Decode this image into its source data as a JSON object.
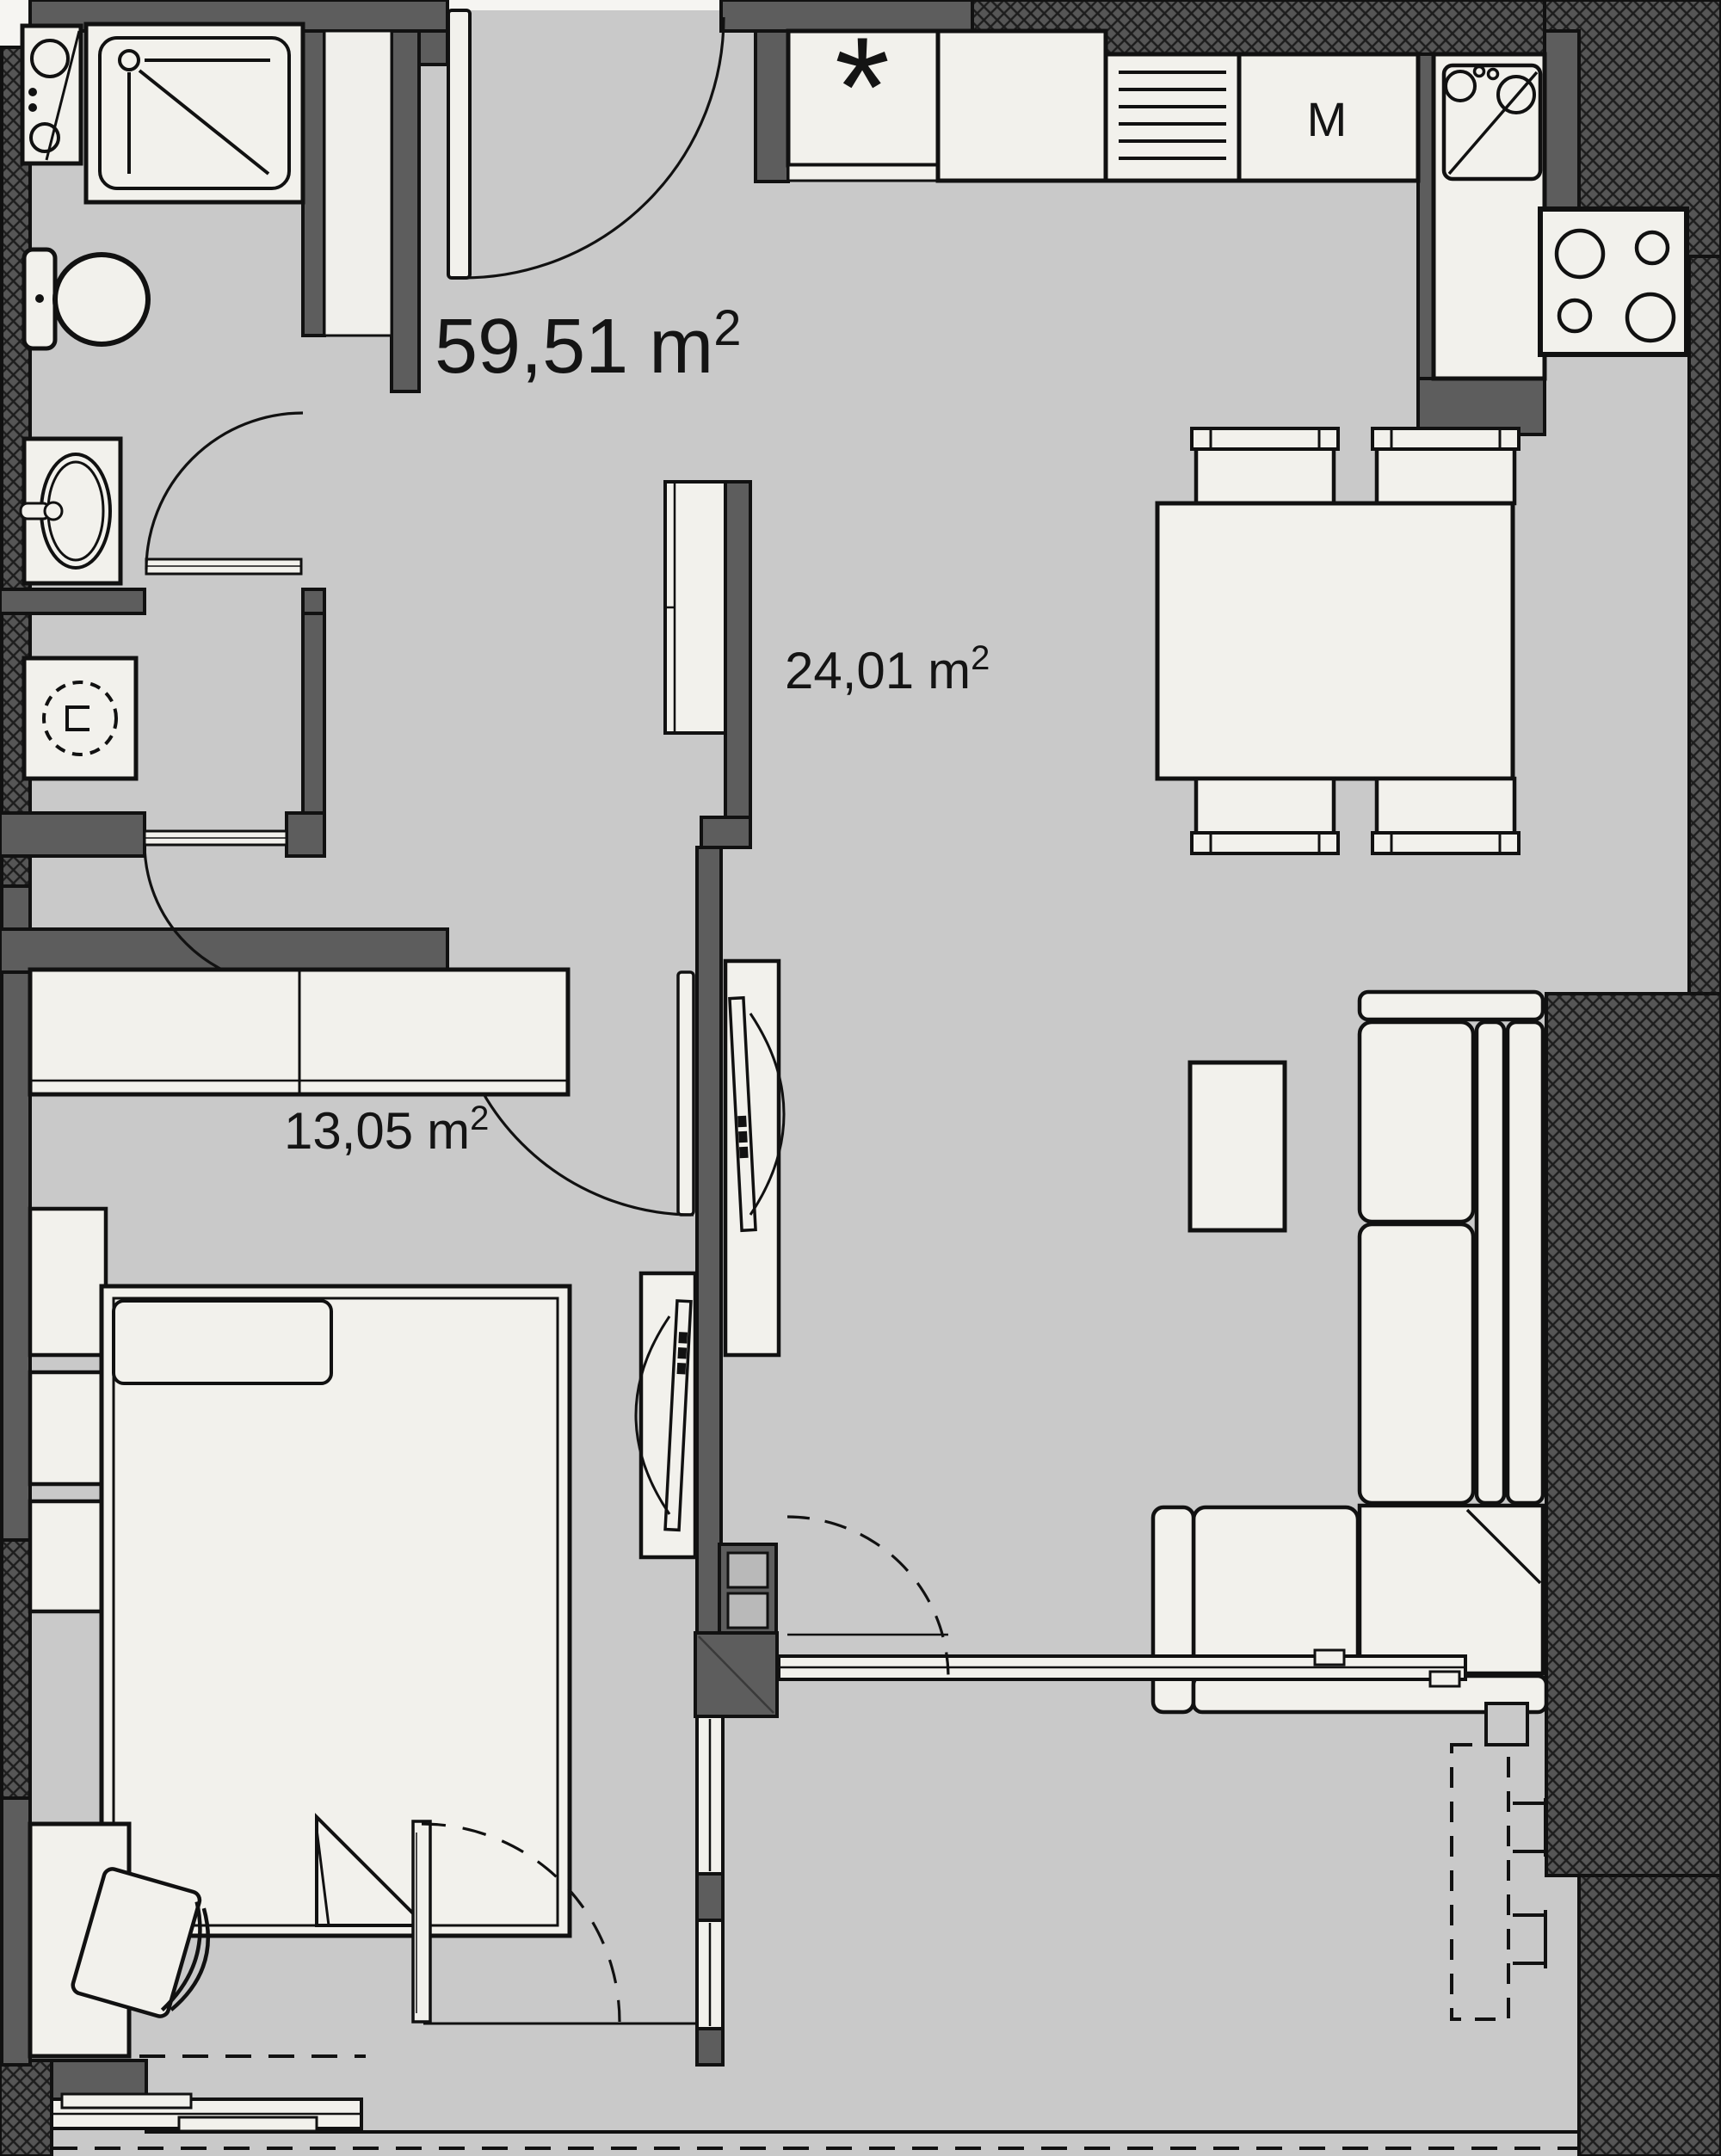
{
  "floor_plan": {
    "areas": {
      "total": {
        "value": "59,51",
        "unit": "m",
        "exp": "2"
      },
      "living_dining": {
        "value": "24,01",
        "unit": "m",
        "exp": "2"
      },
      "bedroom": {
        "value": "13,05",
        "unit": "m",
        "exp": "2"
      }
    },
    "markers": {
      "fridge": "*",
      "dishwasher": "M"
    },
    "colors": {
      "floor": "#c9c9c9",
      "furniture": "#f2f1ec",
      "wall": "#5d5d5d",
      "line": "#111111",
      "outside": "#f6f5f2",
      "shaft_fill": "#b9b9b9"
    },
    "symbols": [
      "shower-tray",
      "utility-sink",
      "toilet",
      "washbasin",
      "washing-machine",
      "entry-door",
      "bathroom-door",
      "wc-door",
      "bedroom-door",
      "hall-wardrobe",
      "kitchen-fridge",
      "kitchen-counter",
      "dish-rack",
      "dishwasher",
      "kitchen-sink",
      "stove",
      "dining-table",
      "dining-chair",
      "coffee-table",
      "sofa",
      "tv-unit-living",
      "tv-unit-bedroom",
      "bedroom-wardrobe",
      "nightstand",
      "bed",
      "desk",
      "desk-chair",
      "balcony-sliding-door",
      "balcony-window",
      "balcony-table-dashed",
      "balcony-chair",
      "shaft"
    ]
  }
}
